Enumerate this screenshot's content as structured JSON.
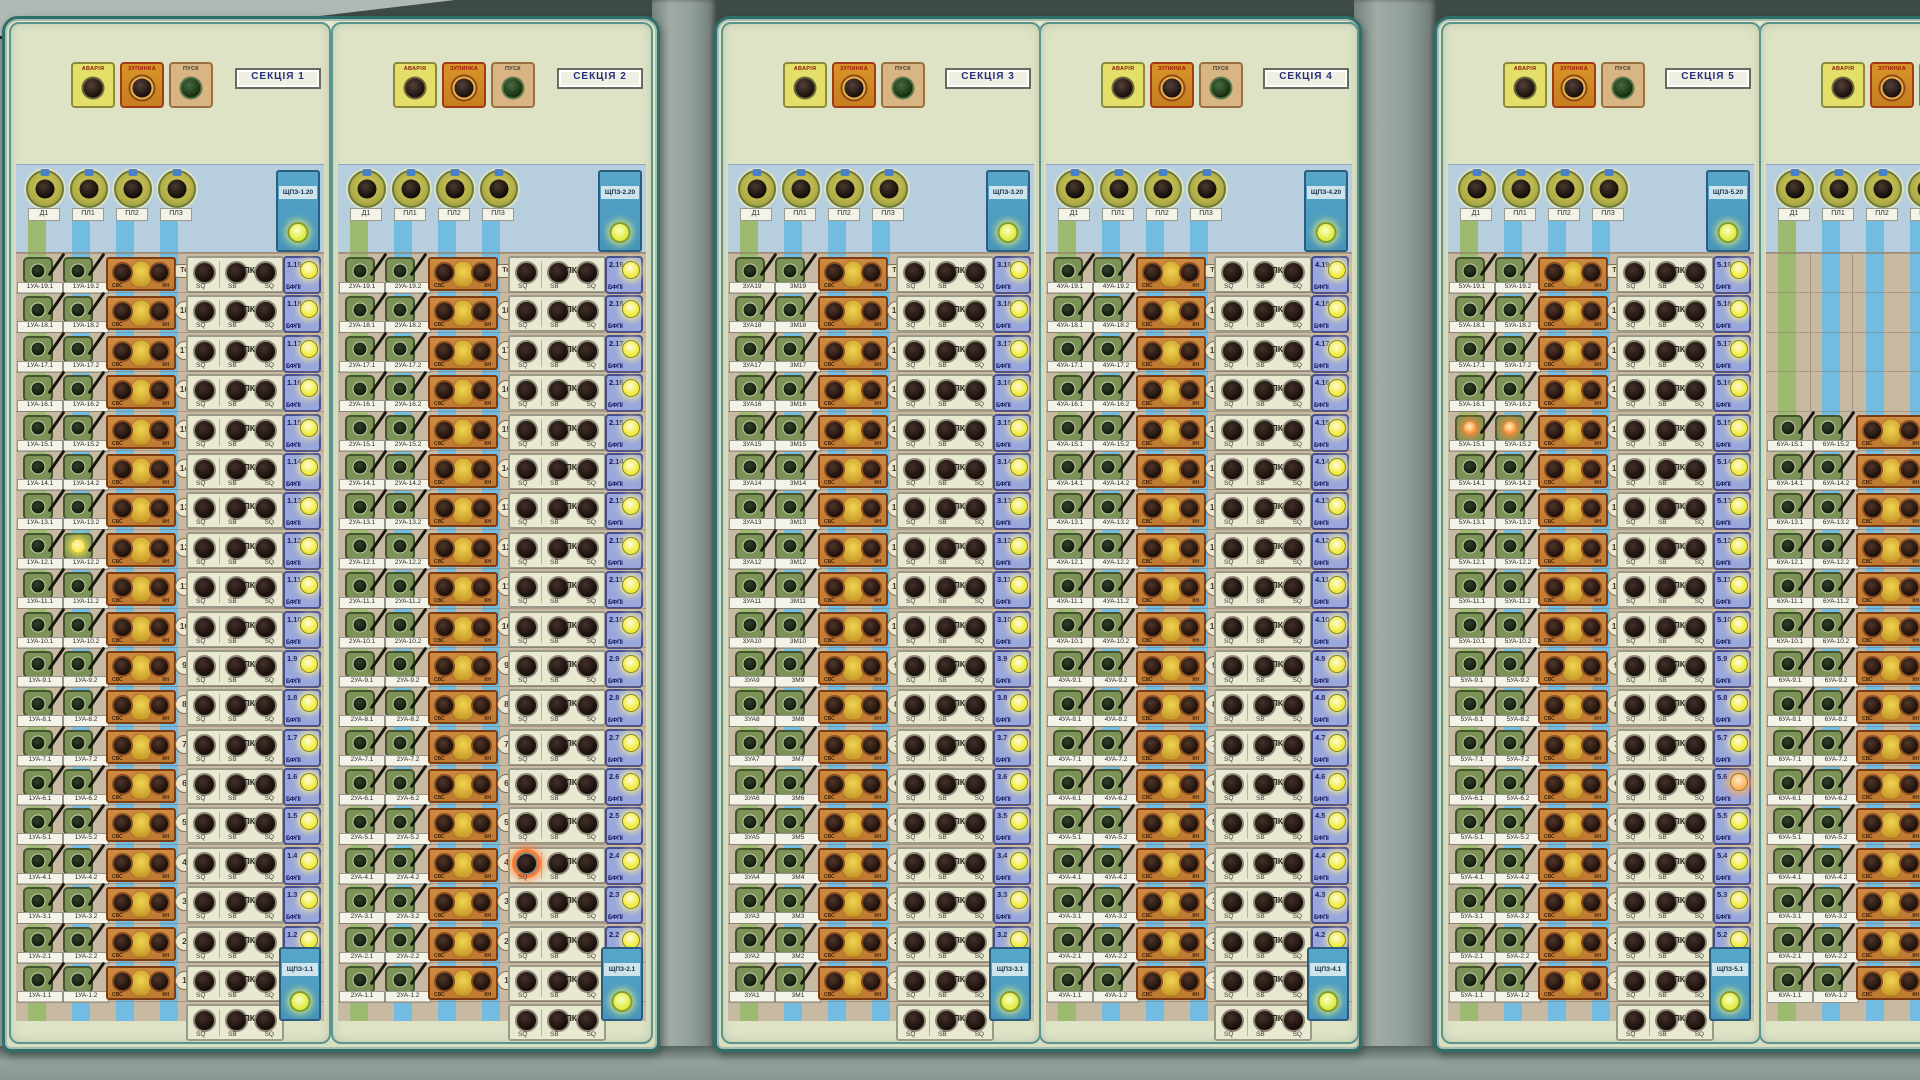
{
  "colors": {
    "panel_face": "#dee3c6",
    "sub_header": "#b6cedd",
    "rows_bg": "#c8b9a3",
    "stripe_green": "#9cba70",
    "stripe_blue": "#72bce2",
    "module_blue": "#9aa7dc",
    "relay_blue": "#4f9ec4",
    "light_yellow": "#f1ec3c",
    "light_lime": "#dcec42",
    "alarm_yellow": "#e4df68",
    "stop_orange": "#d89428"
  },
  "common": {
    "alarm_label": "АВАРІЯ",
    "stop_label": "ЗУПИНКА",
    "start_label": "ПУСК",
    "dial_labels": [
      "Д1",
      "ПЛ1",
      "ПЛ2",
      "ПЛ3"
    ],
    "orange_left": "СВС",
    "orange_right": "КН",
    "sq": "SQ",
    "sb": "SB",
    "pk": "ПК",
    "tech_badge": "Тех",
    "module_type": "БФПІ"
  },
  "sections": [
    {
      "title": "СЕКЦІЯ 1",
      "top_module": "ЩПЗ-1.20",
      "bottom_module": "ЩПЗ-1.1",
      "partial": false,
      "rows": [
        {
          "badge": "Тех",
          "tech": true,
          "l1": "1УА-19.1",
          "l2": "1УА-19.2",
          "mod": "1.19"
        },
        {
          "badge": "18",
          "l1": "1УА-18.1",
          "l2": "1УА-18.2",
          "mod": "1.18"
        },
        {
          "badge": "17",
          "l1": "1УА-17.1",
          "l2": "1УА-17.2",
          "mod": "1.17"
        },
        {
          "badge": "16",
          "l1": "1УА-16.1",
          "l2": "1УА-16.2",
          "mod": "1.16"
        },
        {
          "badge": "15",
          "l1": "1УА-15.1",
          "l2": "1УА-15.2",
          "mod": "1.15"
        },
        {
          "badge": "14",
          "l1": "1УА-14.1",
          "l2": "1УА-14.2",
          "mod": "1.14"
        },
        {
          "badge": "13",
          "l1": "1УА-13.1",
          "l2": "1УА-13.2",
          "mod": "1.13"
        },
        {
          "badge": "12",
          "l1": "1УА-12.1",
          "l2": "1УА-12.2",
          "mod": "1.12",
          "lit_l2": "#ffe94a"
        },
        {
          "badge": "11",
          "l1": "1УА-11.1",
          "l2": "1УА-11.2",
          "mod": "1.11"
        },
        {
          "badge": "10",
          "l1": "1УА-10.1",
          "l2": "1УА-10.2",
          "mod": "1.10"
        },
        {
          "badge": "9",
          "l1": "1УА-9.1",
          "l2": "1УА-9.2",
          "mod": "1.9"
        },
        {
          "badge": "8",
          "l1": "1УА-8.1",
          "l2": "1УА-8.2",
          "mod": "1.8"
        },
        {
          "badge": "7",
          "l1": "1УА-7.1",
          "l2": "1УА-7.2",
          "mod": "1.7"
        },
        {
          "badge": "6",
          "l1": "1УА-6.1",
          "l2": "1УА-6.2",
          "mod": "1.6"
        },
        {
          "badge": "5",
          "l1": "1УА-5.1",
          "l2": "1УА-5.2",
          "mod": "1.5"
        },
        {
          "badge": "4",
          "l1": "1УА-4.1",
          "l2": "1УА-4.2",
          "mod": "1.4"
        },
        {
          "badge": "3",
          "l1": "1УА-3.1",
          "l2": "1УА-3.2",
          "mod": "1.3"
        },
        {
          "badge": "2",
          "l1": "1УА-2.1",
          "l2": "1УА-2.2",
          "mod": "1.2"
        },
        {
          "badge": "1",
          "l1": "1УА-1.1",
          "l2": "1УА-1.2",
          "mod": ""
        }
      ]
    },
    {
      "title": "СЕКЦІЯ 2",
      "top_module": "ЩПЗ-2.20",
      "bottom_module": "ЩПЗ-2.1",
      "partial": false,
      "rows": [
        {
          "badge": "Тех",
          "tech": true,
          "l1": "2УА-19.1",
          "l2": "2УА-19.2",
          "mod": "2.19"
        },
        {
          "badge": "18",
          "l1": "2УА-18.1",
          "l2": "2УА-18.2",
          "mod": "2.18"
        },
        {
          "badge": "17",
          "l1": "2УА-17.1",
          "l2": "2УА-17.2",
          "mod": "2.17"
        },
        {
          "badge": "16",
          "l1": "2УА-16.1",
          "l2": "2УА-16.2",
          "mod": "2.16"
        },
        {
          "badge": "15",
          "l1": "2УА-15.1",
          "l2": "2УА-15.2",
          "mod": "2.15"
        },
        {
          "badge": "14",
          "l1": "2УА-14.1",
          "l2": "2УА-14.2",
          "mod": "2.14"
        },
        {
          "badge": "13",
          "l1": "2УА-13.1",
          "l2": "2УА-13.2",
          "mod": "2.13"
        },
        {
          "badge": "12",
          "l1": "2УА-12.1",
          "l2": "2УА-12.2",
          "mod": "2.12"
        },
        {
          "badge": "11",
          "l1": "2УА-11.1",
          "l2": "2УА-11.2",
          "mod": "2.11"
        },
        {
          "badge": "10",
          "l1": "2УА-10.1",
          "l2": "2УА-10.2",
          "mod": "2.10"
        },
        {
          "badge": "9",
          "l1": "2УА-9.1",
          "l2": "2УА-9.2",
          "mod": "2.9"
        },
        {
          "badge": "8",
          "l1": "2УА-8.1",
          "l2": "2УА-8.2",
          "mod": "2.8"
        },
        {
          "badge": "7",
          "l1": "2УА-7.1",
          "l2": "2УА-7.2",
          "mod": "2.7"
        },
        {
          "badge": "6",
          "l1": "2УА-6.1",
          "l2": "2УА-6.2",
          "mod": "2.6"
        },
        {
          "badge": "5",
          "l1": "2УА-5.1",
          "l2": "2УА-5.2",
          "mod": "2.5"
        },
        {
          "badge": "4",
          "l1": "2УА-4.1",
          "l2": "2УА-4.2",
          "mod": "2.4",
          "lit_sq1": "#ff7a30"
        },
        {
          "badge": "3",
          "l1": "2УА-3.1",
          "l2": "2УА-3.2",
          "mod": "2.3"
        },
        {
          "badge": "2",
          "l1": "2УА-2.1",
          "l2": "2УА-2.2",
          "mod": "2.2"
        },
        {
          "badge": "1",
          "l1": "2УА-1.1",
          "l2": "2УА-1.2",
          "mod": ""
        }
      ]
    },
    {
      "title": "СЕКЦІЯ 3",
      "top_module": "ЩПЗ-3.20",
      "bottom_module": "ЩПЗ-3.1",
      "partial": false,
      "rows": [
        {
          "badge": "Тех",
          "tech": true,
          "l1": "3УА19",
          "l2": "3М19",
          "mod": "3.19"
        },
        {
          "badge": "18",
          "l1": "3УА18",
          "l2": "3М18",
          "mod": "3.18"
        },
        {
          "badge": "17",
          "l1": "3УА17",
          "l2": "3М17",
          "mod": "3.17"
        },
        {
          "badge": "16",
          "l1": "3УА16",
          "l2": "3М16",
          "mod": "3.16"
        },
        {
          "badge": "15",
          "l1": "3УА15",
          "l2": "3М15",
          "mod": "3.15"
        },
        {
          "badge": "14",
          "l1": "3УА14",
          "l2": "3М14",
          "mod": "3.14"
        },
        {
          "badge": "13",
          "l1": "3УА13",
          "l2": "3М13",
          "mod": "3.13"
        },
        {
          "badge": "12",
          "l1": "3УА12",
          "l2": "3М12",
          "mod": "3.12"
        },
        {
          "badge": "11",
          "l1": "3УА11",
          "l2": "3М11",
          "mod": "3.11"
        },
        {
          "badge": "10",
          "l1": "3УА10",
          "l2": "3М10",
          "mod": "3.10"
        },
        {
          "badge": "9",
          "l1": "3УА9",
          "l2": "3М9",
          "mod": "3.9"
        },
        {
          "badge": "8",
          "l1": "3УА8",
          "l2": "3М8",
          "mod": "3.8"
        },
        {
          "badge": "7",
          "l1": "3УА7",
          "l2": "3М7",
          "mod": "3.7"
        },
        {
          "badge": "6",
          "l1": "3УА6",
          "l2": "3М6",
          "mod": "3.6"
        },
        {
          "badge": "5",
          "l1": "3УА5",
          "l2": "3М5",
          "mod": "3.5"
        },
        {
          "badge": "4",
          "l1": "3УА4",
          "l2": "3М4",
          "mod": "3.4"
        },
        {
          "badge": "3",
          "l1": "3УА3",
          "l2": "3М3",
          "mod": "3.3"
        },
        {
          "badge": "2",
          "l1": "3УА2",
          "l2": "3М2",
          "mod": "3.2"
        },
        {
          "badge": "1",
          "l1": "3УА1",
          "l2": "3М1",
          "mod": ""
        }
      ]
    },
    {
      "title": "СЕКЦІЯ 4",
      "top_module": "ЩПЗ-4.20",
      "bottom_module": "ЩПЗ-4.1",
      "partial": false,
      "rows": [
        {
          "badge": "Тех",
          "tech": true,
          "l1": "4УА-19.1",
          "l2": "4УА-19.2",
          "mod": "4.19"
        },
        {
          "badge": "18",
          "l1": "4УА-18.1",
          "l2": "4УА-18.2",
          "mod": "4.18"
        },
        {
          "badge": "17",
          "l1": "4УА-17.1",
          "l2": "4УА-17.2",
          "mod": "4.17"
        },
        {
          "badge": "16",
          "l1": "4УА-16.1",
          "l2": "4УА-16.2",
          "mod": "4.16"
        },
        {
          "badge": "15",
          "l1": "4УА-15.1",
          "l2": "4УА-15.2",
          "mod": "4.15"
        },
        {
          "badge": "14",
          "l1": "4УА-14.1",
          "l2": "4УА-14.2",
          "mod": "4.14"
        },
        {
          "badge": "13",
          "l1": "4УА-13.1",
          "l2": "4УА-13.2",
          "mod": "4.13"
        },
        {
          "badge": "12",
          "l1": "4УА-12.1",
          "l2": "4УА-12.2",
          "mod": "4.12"
        },
        {
          "badge": "11",
          "l1": "4УА-11.1",
          "l2": "4УА-11.2",
          "mod": "4.11"
        },
        {
          "badge": "10",
          "l1": "4УА-10.1",
          "l2": "4УА-10.2",
          "mod": "4.10"
        },
        {
          "badge": "9",
          "l1": "4УА-9.1",
          "l2": "4УА-9.2",
          "mod": "4.9"
        },
        {
          "badge": "8",
          "l1": "4УА-8.1",
          "l2": "4УА-8.2",
          "mod": "4.8"
        },
        {
          "badge": "7",
          "l1": "4УА-7.1",
          "l2": "4УА-7.2",
          "mod": "4.7"
        },
        {
          "badge": "6",
          "l1": "4УА-6.1",
          "l2": "4УА-6.2",
          "mod": "4.6"
        },
        {
          "badge": "5",
          "l1": "4УА-5.1",
          "l2": "4УА-5.2",
          "mod": "4.5"
        },
        {
          "badge": "4",
          "l1": "4УА-4.1",
          "l2": "4УА-4.2",
          "mod": "4.4"
        },
        {
          "badge": "3",
          "l1": "4УА-3.1",
          "l2": "4УА-3.2",
          "mod": "4.3"
        },
        {
          "badge": "2",
          "l1": "4УА-2.1",
          "l2": "4УА-2.2",
          "mod": "4.2"
        },
        {
          "badge": "1",
          "l1": "4УА-1.1",
          "l2": "4УА-1.2",
          "mod": ""
        }
      ]
    },
    {
      "title": "СЕКЦІЯ 5",
      "top_module": "ЩПЗ-5.20",
      "bottom_module": "ЩПЗ-5.1",
      "partial": false,
      "rows": [
        {
          "badge": "Тех",
          "tech": true,
          "l1": "5УА-19.1",
          "l2": "5УА-19.2",
          "mod": "5.19"
        },
        {
          "badge": "18",
          "l1": "5УА-18.1",
          "l2": "5УА-18.2",
          "mod": "5.18"
        },
        {
          "badge": "17",
          "l1": "5УА-17.1",
          "l2": "5УА-17.2",
          "mod": "5.17"
        },
        {
          "badge": "16",
          "l1": "5УА-16.1",
          "l2": "5УА-16.2",
          "mod": "5.16"
        },
        {
          "badge": "15",
          "l1": "5УА-15.1",
          "l2": "5УА-15.2",
          "mod": "5.15",
          "lit_l1": "#ff8c3a",
          "lit_l2": "#ff8c3a"
        },
        {
          "badge": "14",
          "l1": "5УА-14.1",
          "l2": "5УА-14.2",
          "mod": "5.14"
        },
        {
          "badge": "13",
          "l1": "5УА-13.1",
          "l2": "5УА-13.2",
          "mod": "5.13"
        },
        {
          "badge": "12",
          "l1": "5УА-12.1",
          "l2": "5УА-12.2",
          "mod": "5.12"
        },
        {
          "badge": "11",
          "l1": "5УА-11.1",
          "l2": "5УА-11.2",
          "mod": "5.11"
        },
        {
          "badge": "10",
          "l1": "5УА-10.1",
          "l2": "5УА-10.2",
          "mod": "5.10"
        },
        {
          "badge": "9",
          "l1": "5УА-9.1",
          "l2": "5УА-9.2",
          "mod": "5.9"
        },
        {
          "badge": "8",
          "l1": "5УА-8.1",
          "l2": "5УА-8.2",
          "mod": "5.8"
        },
        {
          "badge": "7",
          "l1": "5УА-7.1",
          "l2": "5УА-7.2",
          "mod": "5.7"
        },
        {
          "badge": "6",
          "l1": "5УА-6.1",
          "l2": "5УА-6.2",
          "mod": "5.6",
          "lit_mod": "#ffb060"
        },
        {
          "badge": "5",
          "l1": "5УА-5.1",
          "l2": "5УА-5.2",
          "mod": "5.5"
        },
        {
          "badge": "4",
          "l1": "5УА-4.1",
          "l2": "5УА-4.2",
          "mod": "5.4"
        },
        {
          "badge": "3",
          "l1": "5УА-3.1",
          "l2": "5УА-3.2",
          "mod": "5.3"
        },
        {
          "badge": "2",
          "l1": "5УА-2.1",
          "l2": "5УА-2.2",
          "mod": "5.2"
        },
        {
          "badge": "1",
          "l1": "5УА-1.1",
          "l2": "5УА-1.2",
          "mod": ""
        }
      ]
    },
    {
      "title": "",
      "top_module": "",
      "bottom_module": "",
      "partial": true,
      "rows": [
        {
          "empty": true
        },
        {
          "empty": true
        },
        {
          "empty": true
        },
        {
          "empty": true
        },
        {
          "badge": "",
          "l1": "6УА-15.1",
          "l2": "6УА-15.2",
          "mod": ""
        },
        {
          "badge": "",
          "l1": "6УА-14.1",
          "l2": "6УА-14.2",
          "mod": ""
        },
        {
          "badge": "",
          "l1": "6УА-13.1",
          "l2": "6УА-13.2",
          "mod": ""
        },
        {
          "badge": "",
          "l1": "6УА-12.1",
          "l2": "6УА-12.2",
          "mod": ""
        },
        {
          "badge": "",
          "l1": "6УА-11.1",
          "l2": "6УА-11.2",
          "mod": ""
        },
        {
          "badge": "",
          "l1": "6УА-10.1",
          "l2": "6УА-10.2",
          "mod": ""
        },
        {
          "badge": "",
          "l1": "6УА-9.1",
          "l2": "6УА-9.2",
          "mod": ""
        },
        {
          "badge": "",
          "l1": "6УА-8.1",
          "l2": "6УА-8.2",
          "mod": ""
        },
        {
          "badge": "",
          "l1": "6УА-7.1",
          "l2": "6УА-7.2",
          "mod": ""
        },
        {
          "badge": "",
          "l1": "6УА-6.1",
          "l2": "6УА-6.2",
          "mod": ""
        },
        {
          "badge": "",
          "l1": "6УА-5.1",
          "l2": "6УА-5.2",
          "mod": ""
        },
        {
          "badge": "",
          "l1": "6УА-4.1",
          "l2": "6УА-4.2",
          "mod": ""
        },
        {
          "badge": "",
          "l1": "6УА-3.1",
          "l2": "6УА-3.2",
          "mod": ""
        },
        {
          "badge": "",
          "l1": "6УА-2.1",
          "l2": "6УА-2.2",
          "mod": ""
        },
        {
          "badge": "",
          "l1": "6УА-1.1",
          "l2": "6УА-1.2",
          "mod": ""
        }
      ]
    }
  ]
}
